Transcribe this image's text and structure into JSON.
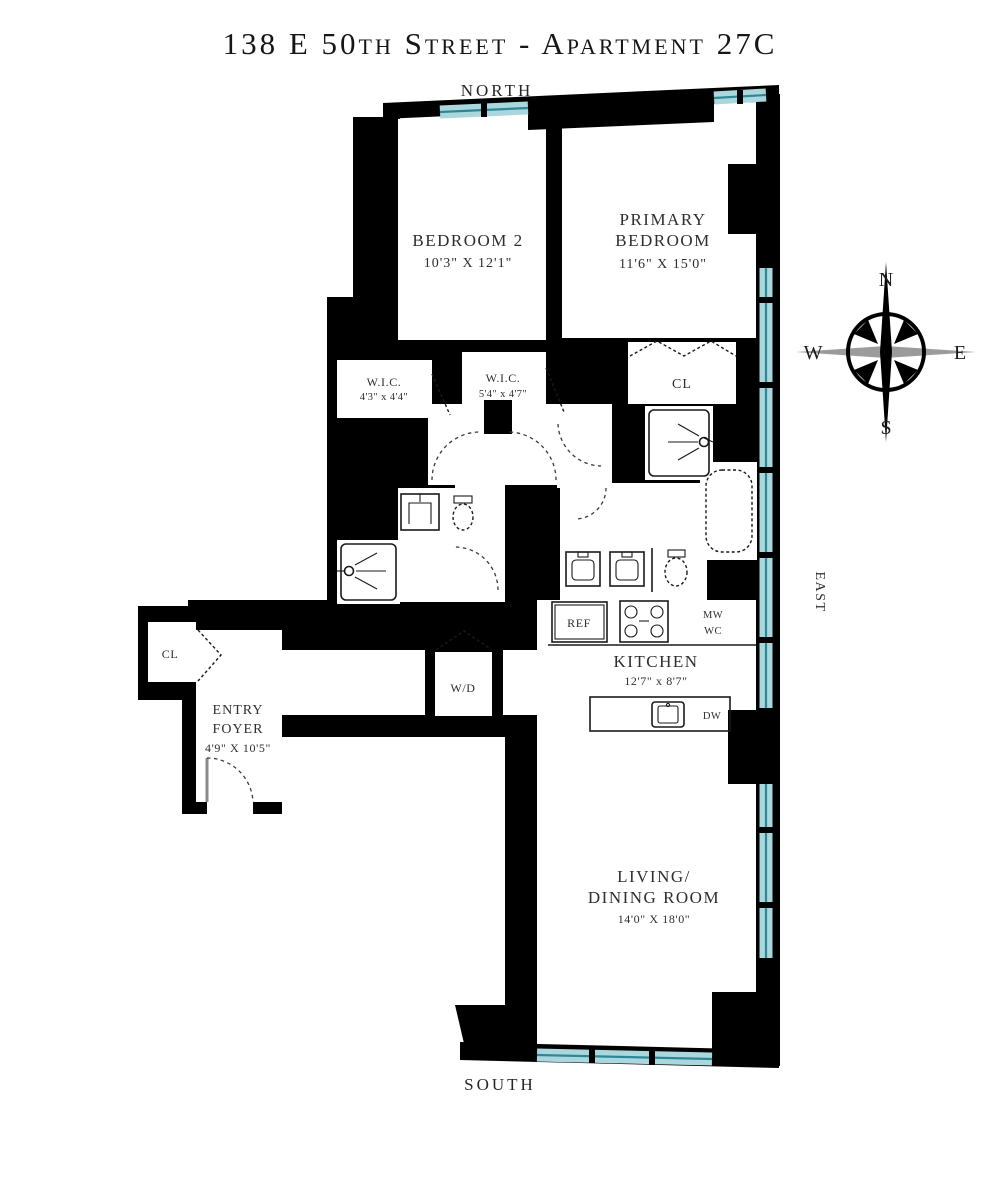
{
  "title": "138 E 50th Street - Apartment 27C",
  "directions": {
    "north": "NORTH",
    "south": "SOUTH",
    "east": "EAST"
  },
  "compass": {
    "north": "N",
    "east": "E",
    "south": "S",
    "west": "W"
  },
  "rooms": {
    "bedroom2": {
      "name": "BEDROOM 2",
      "dims": "10'3\" X 12'1\""
    },
    "primary_bedroom": {
      "name1": "PRIMARY",
      "name2": "BEDROOM",
      "dims": "11'6\" X 15'0\""
    },
    "wic_1": {
      "name": "W.I.C.",
      "dims": "4'3\" x 4'4\""
    },
    "wic_2": {
      "name": "W.I.C.",
      "dims": "5'4\" x 4'7\""
    },
    "primary_closet": {
      "name": "CL"
    },
    "entry_closet": {
      "name": "CL"
    },
    "entry_foyer": {
      "name1": "ENTRY",
      "name2": "FOYER",
      "dims": "4'9\" X 10'5\""
    },
    "kitchen": {
      "name": "KITCHEN",
      "dims": "12'7\" x 8'7\""
    },
    "living_dining": {
      "name1": "LIVING/",
      "name2": "DINING ROOM",
      "dims": "14'0\" X 18'0\""
    },
    "washer_dryer": {
      "name": "W/D"
    }
  },
  "appliances": {
    "refrigerator": "REF",
    "microwave": "MW",
    "wine_cooler": "WC",
    "dishwasher": "DW"
  },
  "colors": {
    "wall": "#000000",
    "window_fill": "#a9d7dd",
    "window_line": "#2f8795",
    "text": "#2e2e2e"
  }
}
